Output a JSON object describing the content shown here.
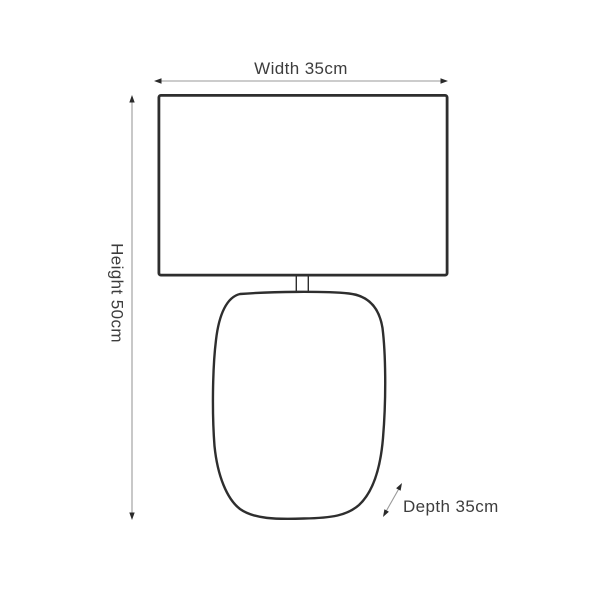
{
  "diagram": {
    "subject": "table lamp dimension drawing",
    "dimensions": {
      "width": {
        "label": "Width 35cm",
        "value_cm": 35
      },
      "height": {
        "label": "Height 50cm",
        "value_cm": 50
      },
      "depth": {
        "label": "Depth 35cm",
        "value_cm": 35
      }
    },
    "colors": {
      "background": "#ffffff",
      "outline": "#2e2e2e",
      "dimension_line": "#9a9a9a",
      "arrowhead": "#2a2a2a",
      "text": "#3d3d3d"
    }
  }
}
